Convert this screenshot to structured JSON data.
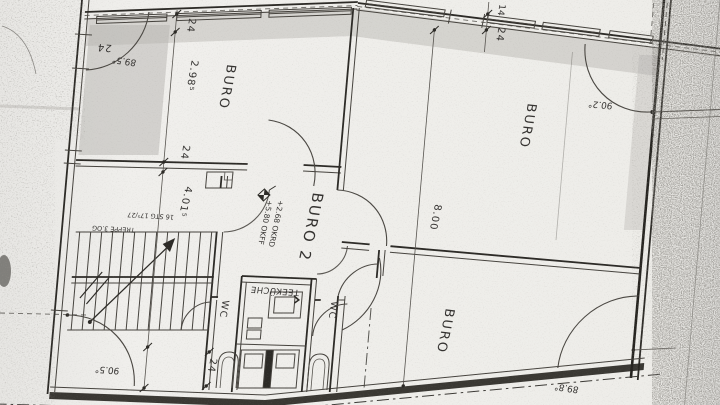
{
  "labels": {
    "room_buro_top_left": "BURO",
    "room_buro_top_right": "BURO",
    "room_buro_bottom_right": "BURO",
    "room_buro2": "BURO 2",
    "room_teekueche": "TEEKÜCHE",
    "room_wc_left": "WC",
    "room_wc_right": "WC"
  },
  "stair": {
    "title": "TREPPE 3.OG",
    "spec": "16 STG 17⁵/27"
  },
  "levels": {
    "ffl": "+5.80 OKFF",
    "slab": "+2.68 OKRD"
  },
  "dimensions": {
    "wall_top_left": "24",
    "seg_top": "24",
    "room_height": "2.98⁵",
    "seg_mid": "24",
    "corridor": "4.01⁵",
    "seg_bottom": "24",
    "pier_width": "14",
    "pier_depth": "24",
    "building_depth": "8.00"
  },
  "angles": {
    "top_left": "89.5°",
    "top_right": "90.2°",
    "bottom_left": "90.5°",
    "bottom_right": "89.8°"
  }
}
